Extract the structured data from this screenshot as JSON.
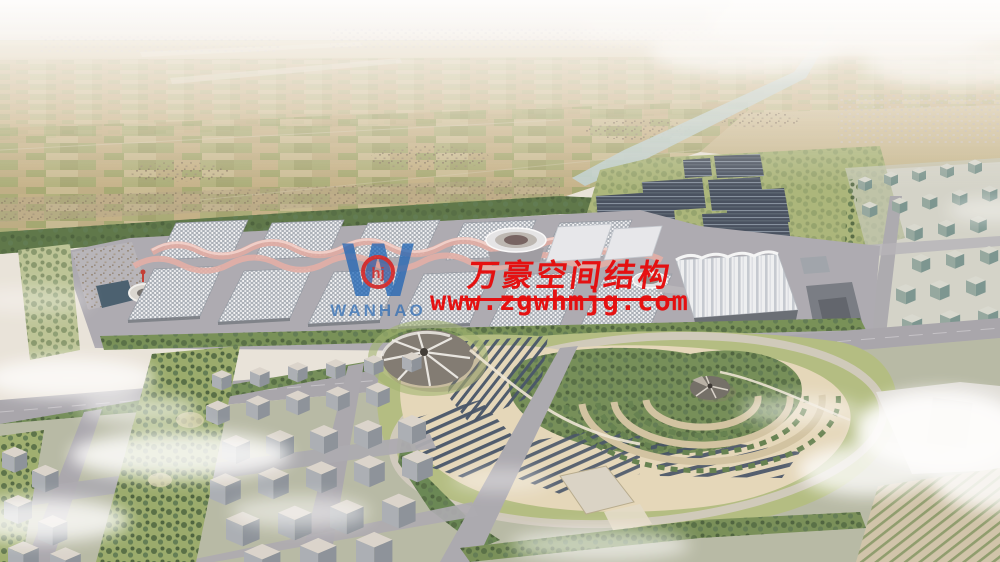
{
  "watermark": {
    "company_cn": "万豪空间结构",
    "website": "www.zgwhmjg.com",
    "logo_word": "WANHAO",
    "logo_monogram": "hj",
    "red": "#e60b0b",
    "blue": "#1e63b4"
  },
  "palette": {
    "sky_haze": "#e9e4dd",
    "farmland_tan": "#c8b488",
    "farmland_green": "#95a260",
    "tree_green": "#4e6a3c",
    "road_grey": "#a3a1a8",
    "roof_grid_grey": "#a7adb6",
    "membrane_pink": "#e0a79e",
    "solar_panel_dark": "#3b4a60",
    "water_canal": "#bccfce",
    "park_sand": "#e4d6b7",
    "lawn_green": "#afba7b",
    "building_grey": "#9ba1a7",
    "cloud_white": "#ffffff"
  },
  "scene": {
    "regions": [
      "hazy horizon farmland plain",
      "irrigation canal",
      "tree belt",
      "exhibition halls with pink membrane ridges",
      "round conference pavilion",
      "white ridge tent hall",
      "solar panel farm blocks",
      "right residential district",
      "central park with circular tent and terraced arcs",
      "left residential district",
      "clouds"
    ]
  }
}
